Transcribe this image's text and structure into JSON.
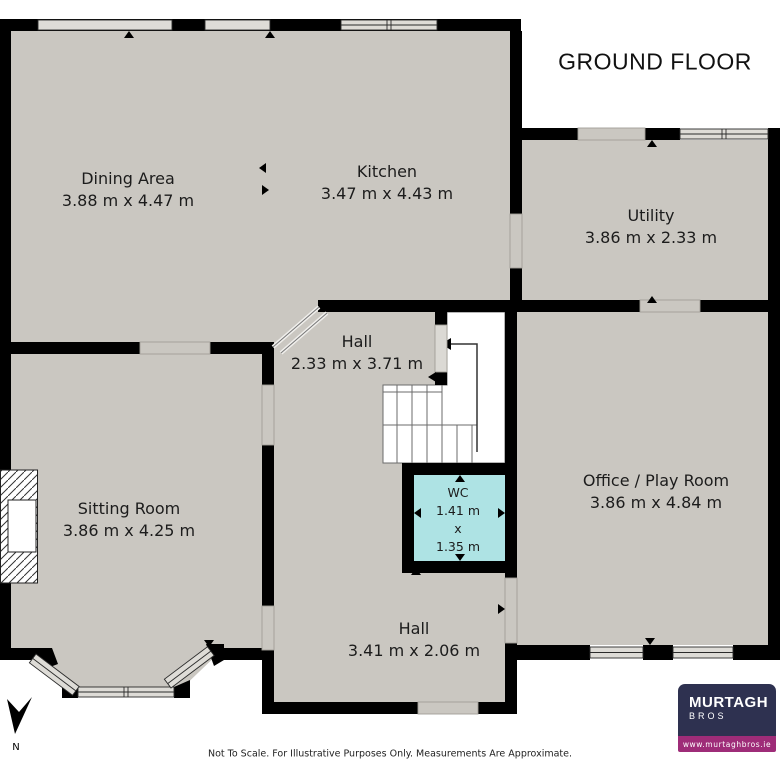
{
  "title": "GROUND FLOOR",
  "disclaimer": "Not To Scale. For Illustrative Purposes Only. Measurements Are Approximate.",
  "compass": {
    "label": "N"
  },
  "rooms": {
    "dining": {
      "name": "Dining Area",
      "dims": "3.88 m x 4.47 m"
    },
    "kitchen": {
      "name": "Kitchen",
      "dims": "3.47 m x 4.43 m"
    },
    "utility": {
      "name": "Utility",
      "dims": "3.86 m x 2.33 m"
    },
    "hall_upper": {
      "name": "Hall",
      "dims": "2.33 m x 3.71 m"
    },
    "sitting": {
      "name": "Sitting Room",
      "dims": "3.86 m x 4.25 m"
    },
    "wc": {
      "name": "WC",
      "width": "1.41 m",
      "sep": "x",
      "depth": "1.35 m"
    },
    "office": {
      "name": "Office / Play Room",
      "dims": "3.86 m x 4.84 m"
    },
    "hall_lower": {
      "name": "Hall",
      "dims": "3.41 m x 2.06 m"
    }
  },
  "logo": {
    "line1": "MURTAGH",
    "line2": "BROS",
    "website": "www.murtaghbros.ie"
  },
  "colors": {
    "wall": "#000000",
    "floor": "#cac7c1",
    "window_fill": "#dedcd7",
    "stairs_fill": "#ffffff",
    "wc_fill": "#aee3e4",
    "text": "#1c1c1c",
    "logo_navy": "#2e3150",
    "logo_magenta": "#9e2c78",
    "logo_text": "#ffffff"
  }
}
